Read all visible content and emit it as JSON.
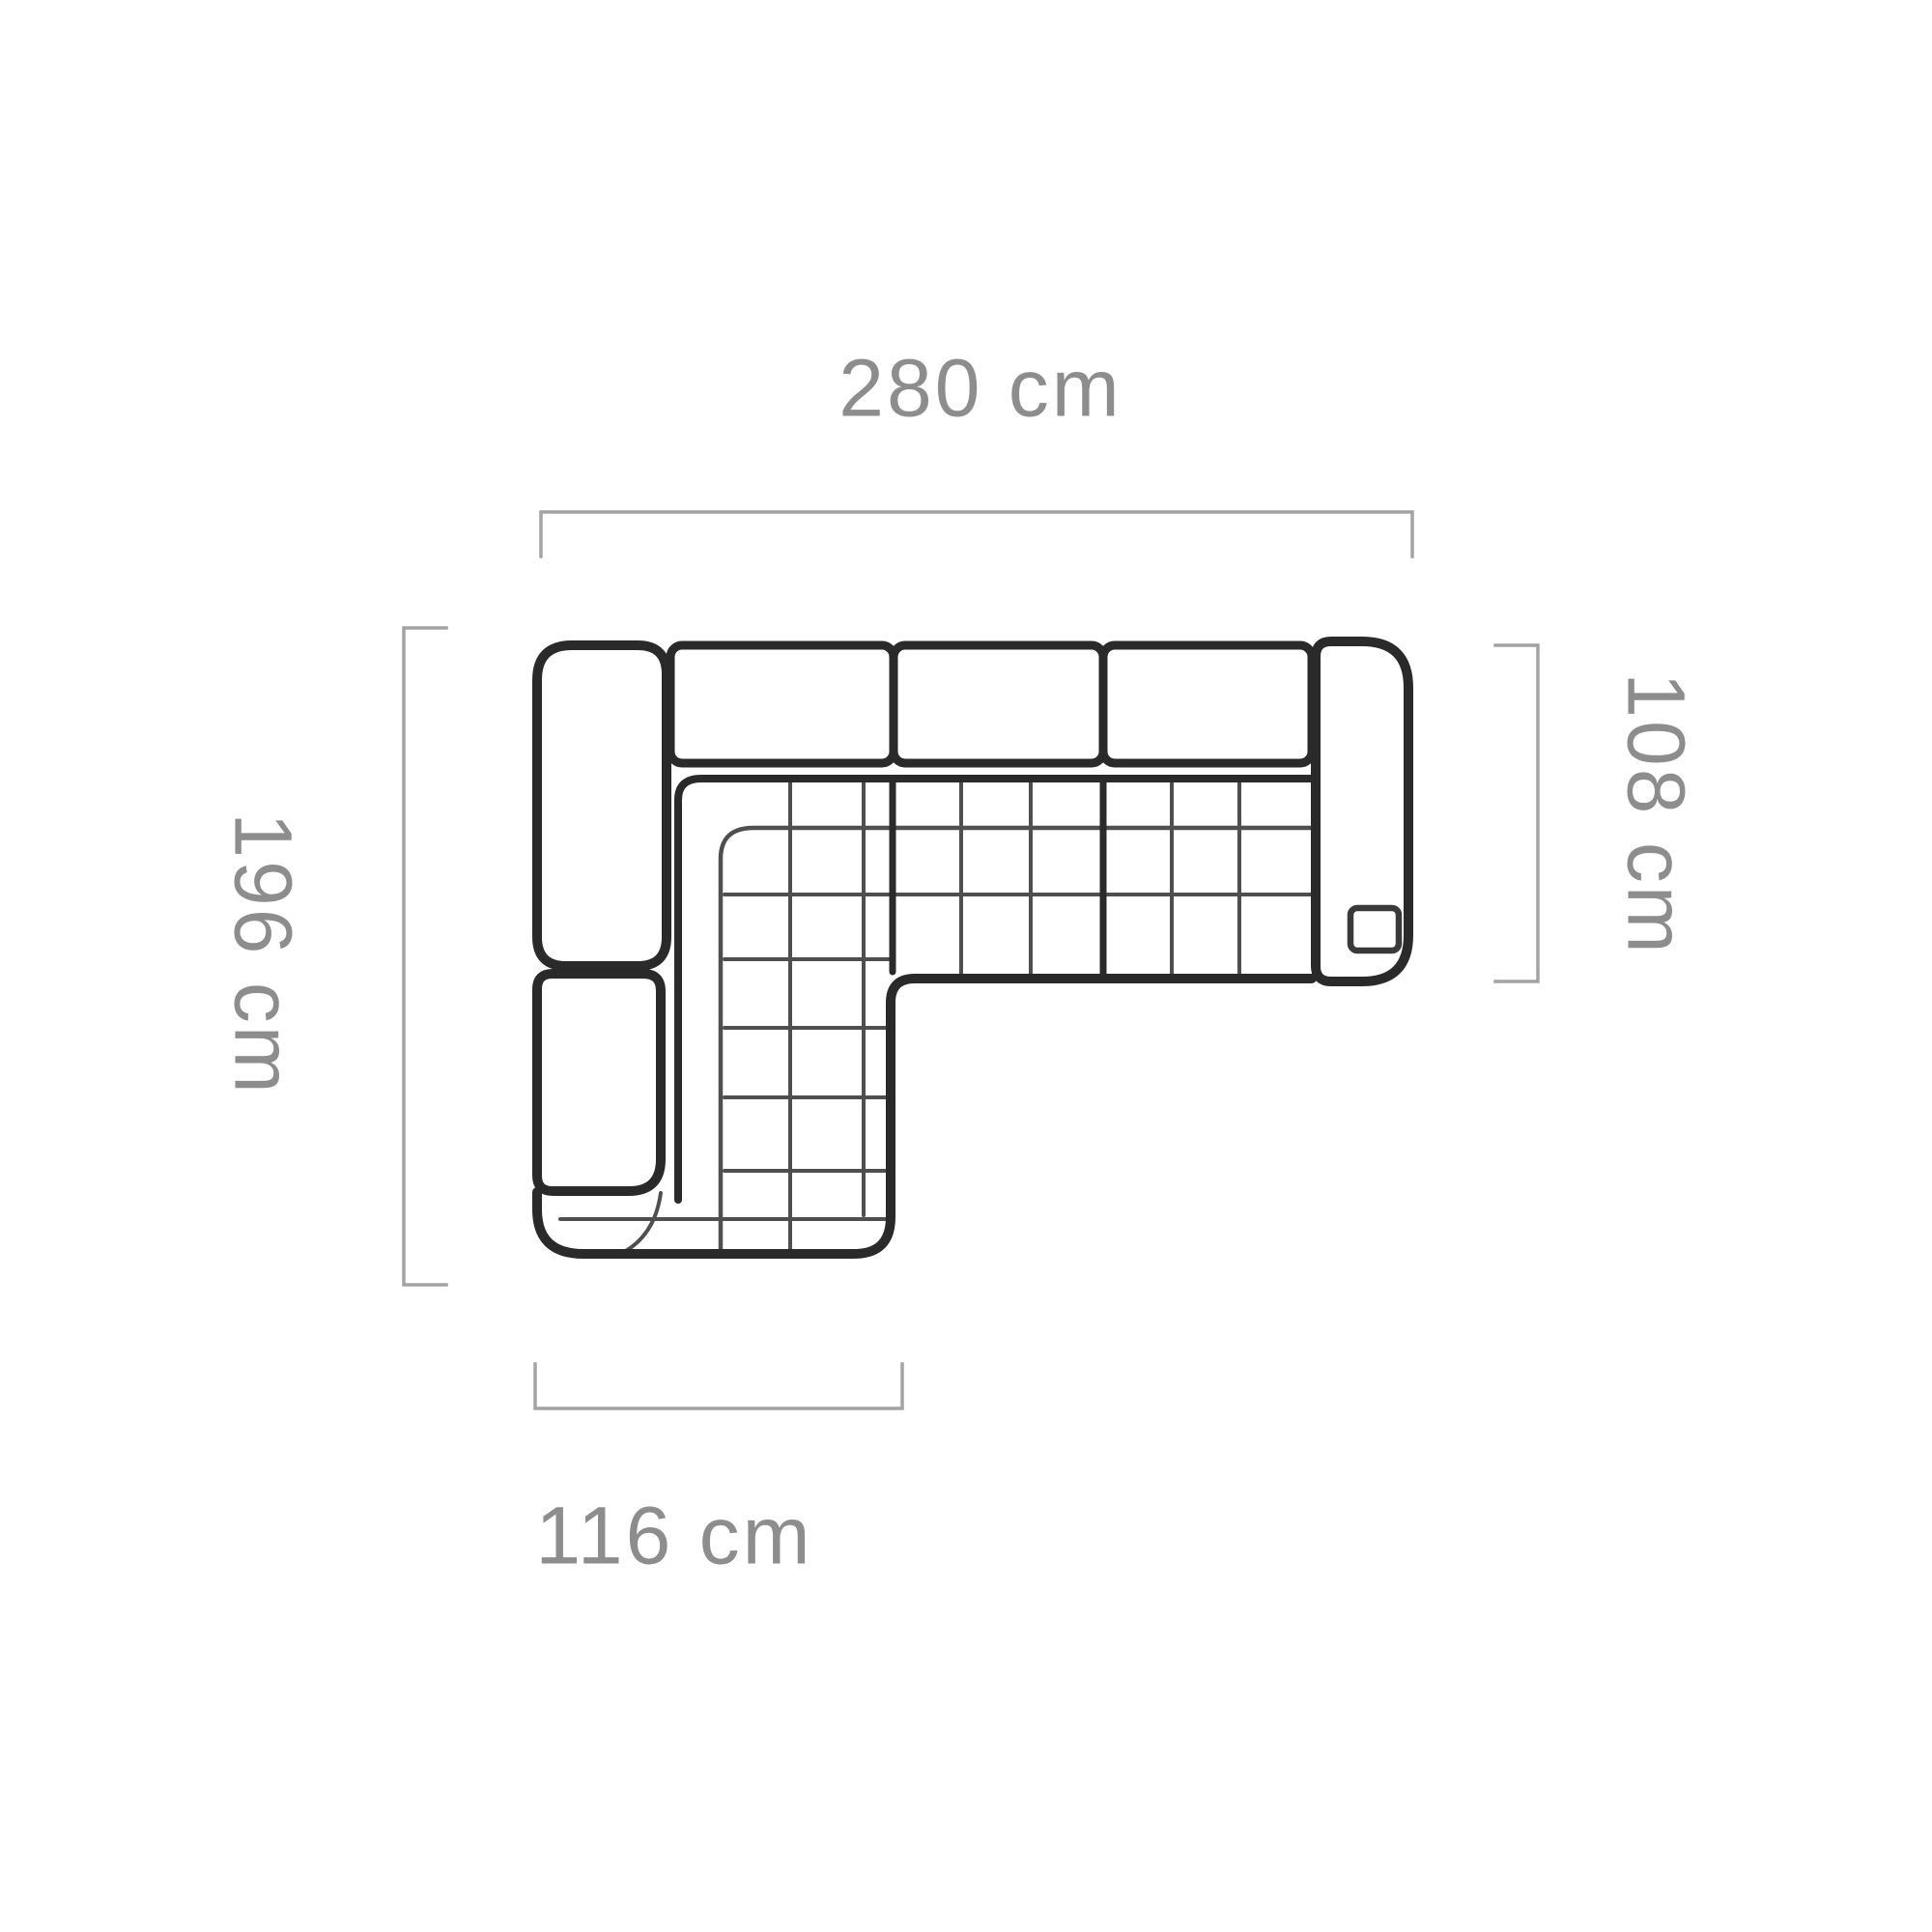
{
  "diagram": {
    "title": "corner-sofa-top-view-dimensions",
    "dimensions": {
      "top": {
        "label": "280 cm",
        "orientation": "horizontal"
      },
      "left": {
        "label": "196 cm",
        "orientation": "vertical"
      },
      "right": {
        "label": "108 cm",
        "orientation": "vertical"
      },
      "bottom": {
        "label": "116 cm",
        "orientation": "horizontal"
      }
    },
    "icons": {
      "arm_detail": "mechanism-square-icon"
    },
    "colors": {
      "outline": "#2a2a2a",
      "quilt": "#4f4f4f",
      "dimension": "#a3a3a3",
      "label": "#8d8d8d",
      "background": "#ffffff"
    }
  }
}
